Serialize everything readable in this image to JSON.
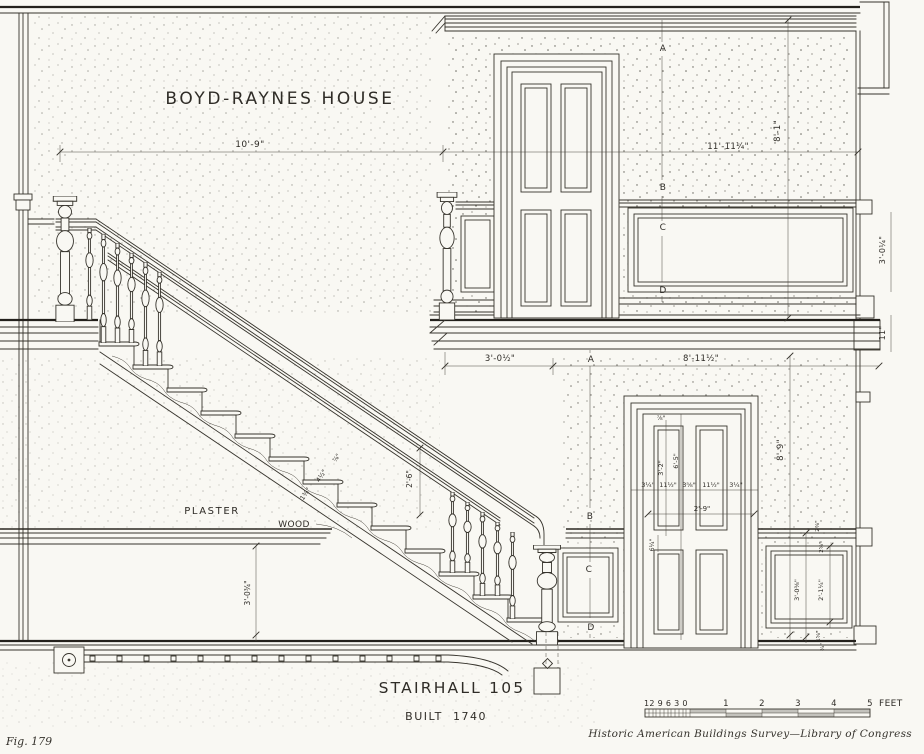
{
  "colors": {
    "paper": "#f9f8f3",
    "ink": "#37342d"
  },
  "title": "BOYD-RAYNES HOUSE",
  "room_label": "STAIRHALL 105",
  "built": {
    "label": "BUILT",
    "year": "1740"
  },
  "figure_caption": "Fig. 179",
  "credit": "Historic American Buildings Survey—Library of Congress",
  "materials": {
    "plaster": "PLASTER",
    "wood": "WOOD"
  },
  "markers": {
    "a": "A",
    "b": "B",
    "c": "C",
    "d": "D"
  },
  "dims": {
    "stair_run": "10'-9\"",
    "upper_hall": "11'-11¼\"",
    "upper_height": "8'-1\"",
    "upper_wainscot": "3'-0¼\"",
    "floor_depth": "11\"",
    "landing": "3'-0½\"",
    "lower_hall": "8'-11½\"",
    "lower_height": "8'-9\"",
    "rail_height": "2'-6\"",
    "nosing": "⅞\"",
    "tread": "4½\"",
    "riser": "1⅜\"",
    "wainscot_left": "3'-0¾\"",
    "door": {
      "stile": "3¼\"",
      "panel": "11½\"",
      "muntin": "3⅝\"",
      "panel2": "11½\"",
      "stile2": "3¼\"",
      "mid_width": "2'-9\"",
      "upper_panel": "3'-2\"",
      "lower_panel": "6'-5\"",
      "top_rail": "⅞\"",
      "lock_rail": "6¼\""
    },
    "right_panel": {
      "height": "3'-0⅜\"",
      "panel": "2'-1¼\"",
      "top1": "2⅞\"",
      "top2": "2⅝\"",
      "bot1": "1⅝\"",
      "bot2": "¾\""
    }
  },
  "scale_bar": {
    "inches": "12 9 6 3 0",
    "feet": [
      "1",
      "2",
      "3",
      "4",
      "5"
    ],
    "unit": "FEET"
  }
}
